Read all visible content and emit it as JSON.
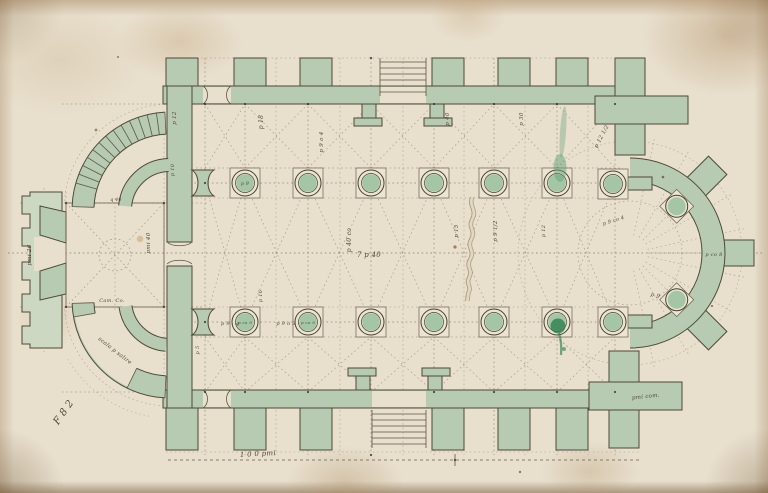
{
  "palette": {
    "paper": "#e8dfcd",
    "paper_edge": "#c3ab84",
    "wall_wash_green": "#b6cbb1",
    "wall_wash_light": "#ccd8c1",
    "column_fill_green": "#9cc2a0",
    "ink_line": "#6b5f4c",
    "wall_outline": "#4e4a39",
    "script_ink": "#463627",
    "smudge_green": "#2e7f4d"
  },
  "plan": {
    "folio_mark": "F 8 2",
    "scale_label": "1 0 0 pmi",
    "annotations": [
      {
        "text": "p 18"
      },
      {
        "text": "p 9 o 4"
      },
      {
        "text": "p 12"
      },
      {
        "text": "p 40 co"
      },
      {
        "text": "7 p 40"
      },
      {
        "text": "p 15"
      },
      {
        "text": "p 9 1/2"
      },
      {
        "text": "p 30"
      },
      {
        "text": "p 12 1/2"
      },
      {
        "text": "p 9"
      },
      {
        "text": "p co 8"
      },
      {
        "text": "p 9 - q"
      },
      {
        "text": "p 9 o 3 -"
      },
      {
        "text": "p 9"
      },
      {
        "text": "p co 9"
      },
      {
        "text": "p co 9"
      },
      {
        "text": "scala p salire"
      },
      {
        "text": "pmi 26"
      },
      {
        "text": "pmi 40"
      },
      {
        "text": "Cam. Co."
      },
      {
        "text": "pmi com."
      },
      {
        "text": "q 40"
      },
      {
        "text": "p 10"
      },
      {
        "text": "p 5"
      },
      {
        "text": "p 16"
      },
      {
        "text": "p 9 co 4"
      },
      {
        "text": "p 40"
      },
      {
        "text": "p 12"
      }
    ]
  }
}
